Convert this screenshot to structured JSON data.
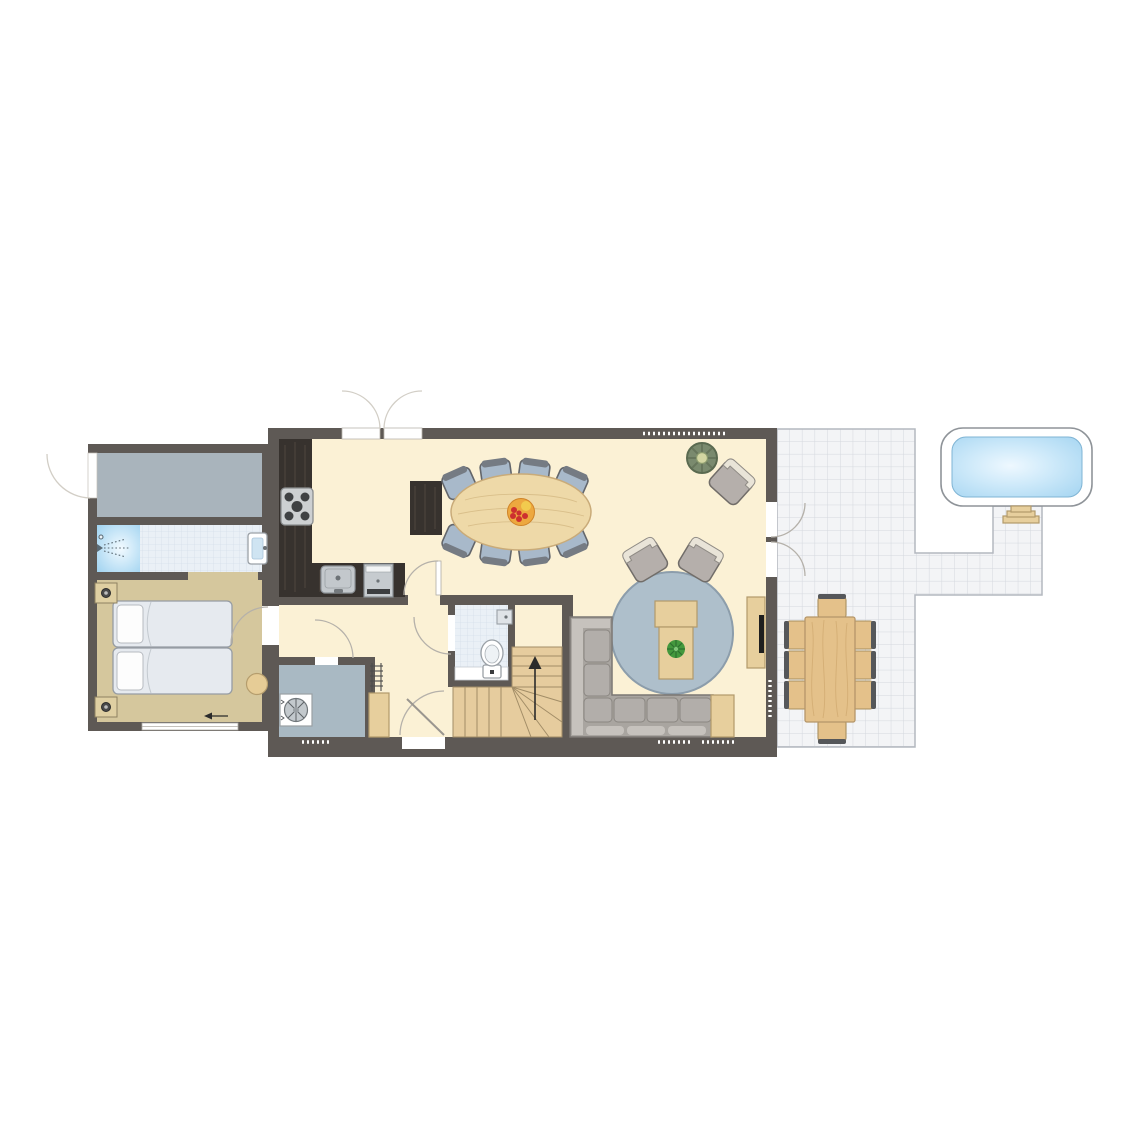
{
  "title": "Holiday home ground floor plan with terrace and hot tub",
  "colors": {
    "page-bg": "#ffffff",
    "wall": "#5e5955",
    "floor-main": "#fbf1d5",
    "floor-bedroom": "#d5c79d",
    "floor-storage": "#a9b4bc",
    "floor-utility": "#a9b9c3",
    "bath-tile": "#eaf0f6",
    "bath-line": "#d5dfea",
    "patio-tile": "#f3f4f6",
    "patio-line": "#d4d8de",
    "patio-border": "#b4b8bf",
    "counter": "#37322e",
    "counter-grain": "#554c44",
    "wood": "#e7cf9d",
    "wood-border": "#b29a6b",
    "table-wood": "#eed9a8",
    "table-border": "#c9ab79",
    "terrace-chair": "#e4c18a",
    "stairs-wood": "#e6cc9e",
    "stairs-line": "#a28d67",
    "rug": "#aebfcb",
    "rug-border": "#8c9dab",
    "chair-seat": "#a8b9ca",
    "chair-dark": "#63666b",
    "chair-back": "#757b83",
    "sofa": "#a9a5a0",
    "sofa-light": "#c6c2bd",
    "sofa-cushion": "#b2aeaa",
    "sofa-border": "#7b7773",
    "armchair": "#b5afab",
    "armchair-back": "#e9e4d8",
    "armchair-border": "#716d69",
    "water": "#a9d7f2",
    "water-light": "#eef8ff",
    "tub-border": "#8f9499",
    "plant-green": "#44983d",
    "plant-dark": "#2d7030",
    "pot-dark": "#67765c",
    "pot-mid": "#8d9c7d",
    "pot-center": "#d3d6a2",
    "fruit-orange": "#eda83f",
    "fruit-red": "#cd2f2f",
    "fruit-yellow": "#f2cb4e",
    "fixture-gray": "#c3c8cc",
    "fixture-border": "#8e9499",
    "shower-blue": "#9ed2f0",
    "arc": "#b5b1aa",
    "arc-light": "#d2cec6",
    "ink": "#2b2b2b"
  },
  "rooms": [
    {
      "id": "kitchen-dining-living",
      "label": "open-plan kitchen, dining and living room"
    },
    {
      "id": "hallway",
      "label": "hallway"
    },
    {
      "id": "wc",
      "label": "toilet room"
    },
    {
      "id": "staircase",
      "label": "winder staircase to upper floor"
    },
    {
      "id": "utility-room",
      "label": "utility room with washing machine"
    },
    {
      "id": "bedroom",
      "label": "bedroom with two single beds"
    },
    {
      "id": "bathroom",
      "label": "bathroom with shower and washbasin"
    },
    {
      "id": "storage-room",
      "label": "storage room"
    },
    {
      "id": "terrace",
      "label": "tiled terrace with outdoor dining set"
    },
    {
      "id": "hot-tub-area",
      "label": "hot tub with entry steps"
    }
  ],
  "furniture_counts": {
    "dining_chairs": 8,
    "terrace_chairs": 8,
    "single_beds": 2,
    "nightstands": 2,
    "armchairs": 3,
    "corner_sofa": 1,
    "coffee_tables": 1,
    "tv_cabinets": 1,
    "hob_burners": 5,
    "washing_machines": 1,
    "toilets": 1,
    "showers": 1,
    "washbasins": 2,
    "hot_tubs": 1,
    "potted_plants": 2
  }
}
